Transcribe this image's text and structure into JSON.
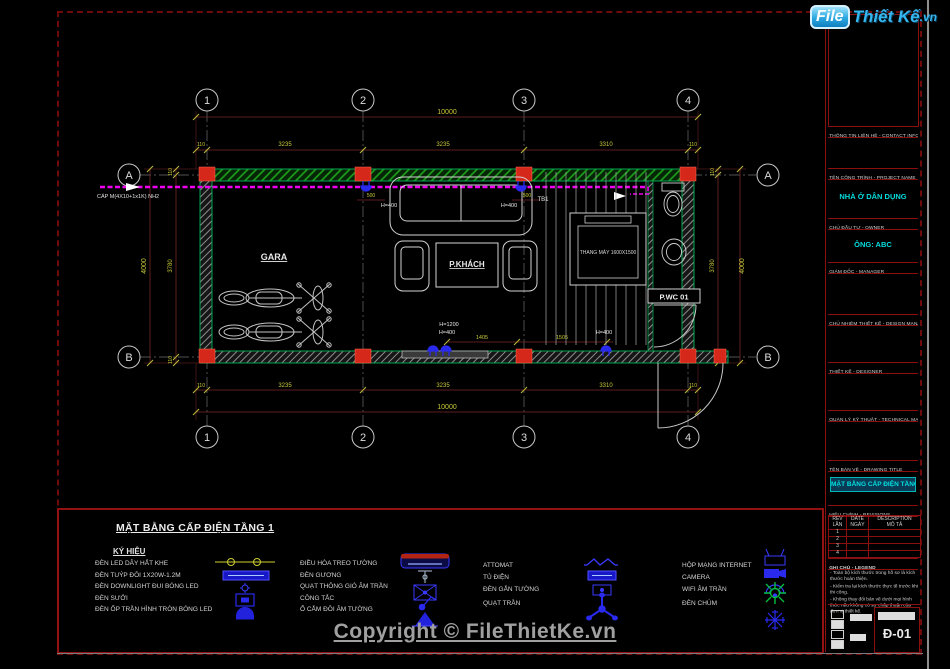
{
  "logo": {
    "file": "File",
    "thiet_ke": "Thiết Kế",
    "vn": ".vn"
  },
  "copyright": "Copyright © FileThietKe.vn",
  "plan": {
    "grid": {
      "cols": [
        "1",
        "2",
        "3",
        "4"
      ],
      "rows": [
        "A",
        "B"
      ]
    },
    "dims": {
      "total_h": "10000",
      "seg_h": [
        "110",
        "3235",
        "3235",
        "3310",
        "110"
      ],
      "total_v": "4000",
      "seg_v": [
        "110",
        "3780",
        "110"
      ]
    },
    "rooms": {
      "gara": "GARA",
      "living": "P.KHÁCH",
      "wc": "P.WC 01",
      "elevator": "THANG MÁY 1600X1500",
      "panel": "TB1"
    },
    "cable_label": "CÁP M(4X10+1x1K) NH2",
    "annotations": {
      "h400": "H=400",
      "h1200": "H=1200",
      "d500": "500",
      "d1405": "1405",
      "d1505": "1505"
    }
  },
  "legend": {
    "sheet_title": "MẶT BẰNG CẤP ĐIỆN TẦNG 1",
    "key_header": "KÝ HIỆU",
    "col1": [
      "ĐÈN LED DÂY HẮT KHE",
      "ĐÈN TUÝP ĐÔI 1X20W-1.2M",
      "ĐÈN DOWNLIGHT ĐUI BÓNG LED",
      "ĐÈN SƯỞI",
      "ĐÈN ỐP TRẦN HÌNH TRÒN BÓNG LED"
    ],
    "col2": [
      "ĐIỀU HÒA TREO TƯỜNG",
      "ĐÈN GƯƠNG",
      "QUẠT THÔNG GIÓ ÂM TRẦN",
      "CÔNG TẮC",
      "Ổ CẮM ĐÔI ÂM TƯỜNG"
    ],
    "col3": [
      "ATTOMAT",
      "TỦ ĐIỆN",
      "ĐÈN GẮN TƯỜNG",
      "QUẠT TRẦN"
    ],
    "col4": [
      "HỘP MẠNG INTERNET",
      "CAMERA",
      "WIFI ÂM TRẦN",
      "ĐÈN CHÙM"
    ]
  },
  "title_block": {
    "contact_header": "THÔNG TIN LIÊN HỆ - CONTACT INFO",
    "project_header": "TÊN CÔNG TRÌNH - PROJECT NAME",
    "project_name": "NHÀ Ở DÂN DỤNG",
    "owner_header": "CHỦ ĐẦU TƯ - OWNER",
    "owner_name": "ÔNG: ABC",
    "manager_header": "GIÁM ĐỐC - MANAGER",
    "design_manager_header": "CHỦ NHIỆM THIẾT KẾ - DESIGN MANAGER",
    "designer_header": "THIẾT KẾ - DESIGNER",
    "technical_manager_header": "QUẢN LÝ KỸ THUẬT - TECHNICAL MANAGER",
    "drawing_title_header": "TÊN BẢN VẼ - DRAWING TITLE",
    "drawing_title": "MẶT BẰNG CẤP ĐIỆN TẦNG 1",
    "revisions_header": "HIỆU CHỈNH - REVISIONS",
    "rev_table": {
      "col1a": "REV",
      "col1b": "LẦN",
      "col2a": "DATE",
      "col2b": "NGÀY",
      "col3a": "DESCRIPTION",
      "col3b": "MÔ TẢ",
      "rows": [
        "1",
        "2",
        "3",
        "4"
      ]
    },
    "notes_header": "GHI CHÚ - LEGEND",
    "notes": [
      "- Toàn bộ kích thước trong hồ sơ là kích thước hoàn thiện.",
      "- Kiểm tra lại kích thước thực tế trước khi thi công.",
      "- Không thay đổi bản vẽ dưới mọi hình thức nếu không có sự chấp thuận của đơn vị thiết kế."
    ],
    "drawing_number": "Đ-01"
  },
  "colors": {
    "accent_cyan": "#00e0e0",
    "dim_yellow": "#c8c838",
    "cable_magenta": "#f000f0",
    "wall_green": "#00a651",
    "column_red": "#d6281a",
    "symbol_blue": "#2a2aee",
    "border_red": "#8a1010",
    "logo_blue": "#29abe2"
  }
}
